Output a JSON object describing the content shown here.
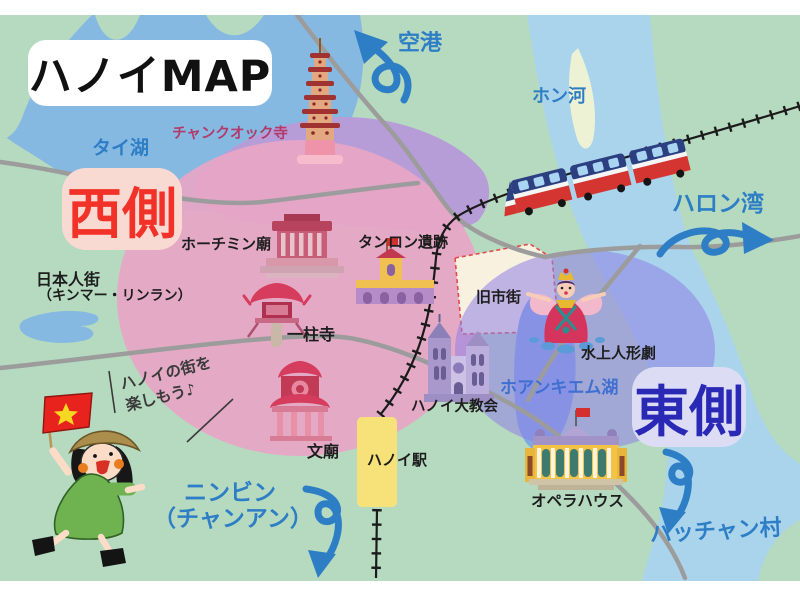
{
  "title": "ハノイMAP",
  "badges": {
    "west": "西側",
    "east": "東側"
  },
  "labels": {
    "tai_lake": "タイ湖",
    "airport": "空港",
    "hong_river": "ホン河",
    "halong_bay": "ハロン湾",
    "tran_quoc_temple": "チャンクオック寺",
    "hcm_mausoleum": "ホーチミン廟",
    "thang_long_ruins": "タンロン遺跡",
    "japanese_town_line1": "日本人街",
    "japanese_town_line2": "（キンマー・リンラン）",
    "one_pillar_pagoda": "一柱寺",
    "temple_of_literature": "文廟",
    "hanoi_station": "ハノイ駅",
    "hanoi_cathedral": "ハノイ大教会",
    "old_quarter": "旧市街",
    "water_puppet_theater": "水上人形劇",
    "hoan_kiem_lake": "ホアンキエム湖",
    "opera_house": "オペラハウス",
    "bat_trang_village": "バッチャン村",
    "ninh_binh_line1": "ニンビン",
    "ninh_binh_line2": "（チャンアン）"
  },
  "callout": {
    "line1": "ハノイの街を",
    "line2": "楽しもう♪"
  },
  "colors": {
    "land": "#b6dabf",
    "lake": "#86b9e2",
    "river": "#a9d4ec",
    "west_zone_pink": "#e8a6c6",
    "north_zone_purple": "#b79dd8",
    "east_zone_purple": "#8f7fe8",
    "label_blue": "#2e7ec6",
    "west_badge_bg": "#f9dad2",
    "west_badge_text": "#f23228",
    "east_badge_bg": "#dcdcf5",
    "east_badge_text": "#2929b6",
    "road_gray": "#9c9c9c",
    "railway_black": "#1b1b1b",
    "old_quarter_cream": "#f8f1e0",
    "station_yellow": "#f7e27a"
  }
}
